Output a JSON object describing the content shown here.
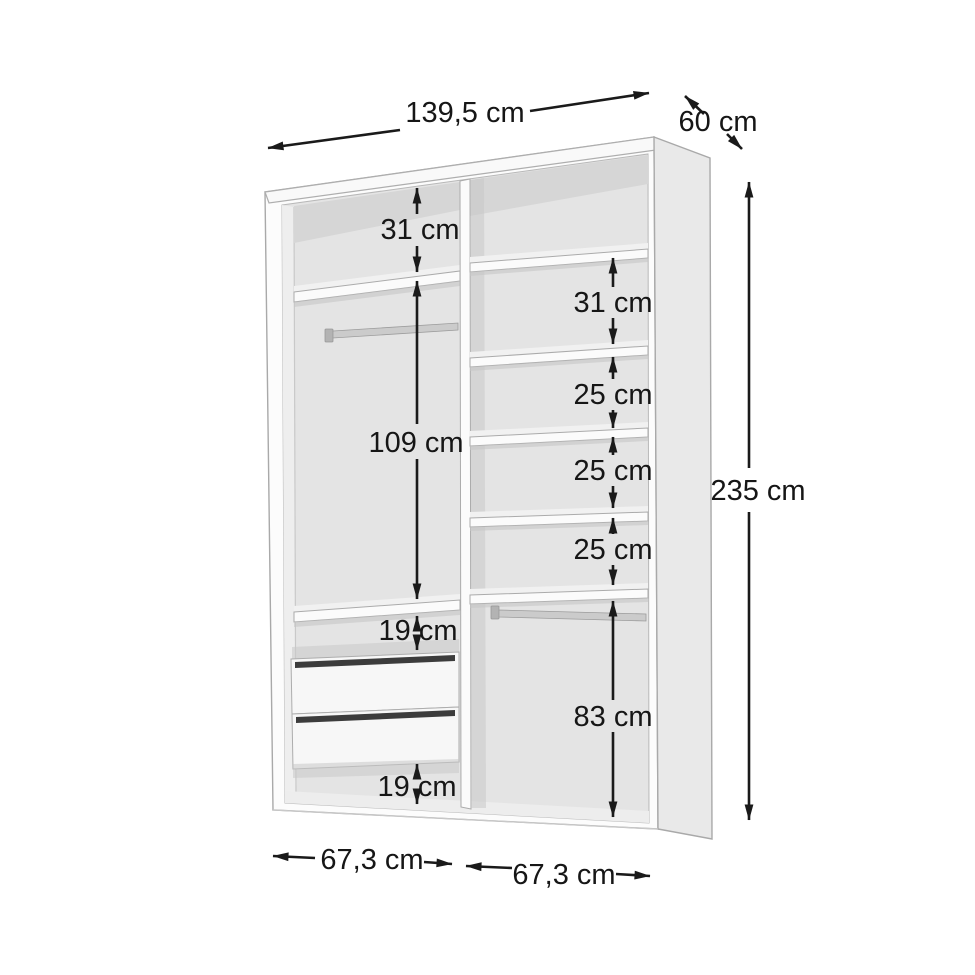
{
  "diagram": {
    "overall": {
      "width": "139,5 cm",
      "depth": "60 cm",
      "height": "235 cm"
    },
    "left_column": {
      "width": "67,3 cm",
      "top_shelf_gap": "31 cm",
      "hanging_section": "109 cm",
      "gap_above_drawers": "19 cm",
      "gap_below_drawers": "19 cm"
    },
    "right_column": {
      "width": "67,3 cm",
      "shelf_gaps": [
        "31 cm",
        "25 cm",
        "25 cm",
        "25 cm"
      ],
      "hanging_section": "83 cm"
    },
    "colors": {
      "dimension_ink": "#1a1a1a",
      "cabinet_surface": "#fcfcfc",
      "cabinet_side": "#e9e9e9",
      "interior_back": "#e4e4e4",
      "drawer_handle_slot": "#3c3c3c",
      "background": "#ffffff"
    }
  }
}
